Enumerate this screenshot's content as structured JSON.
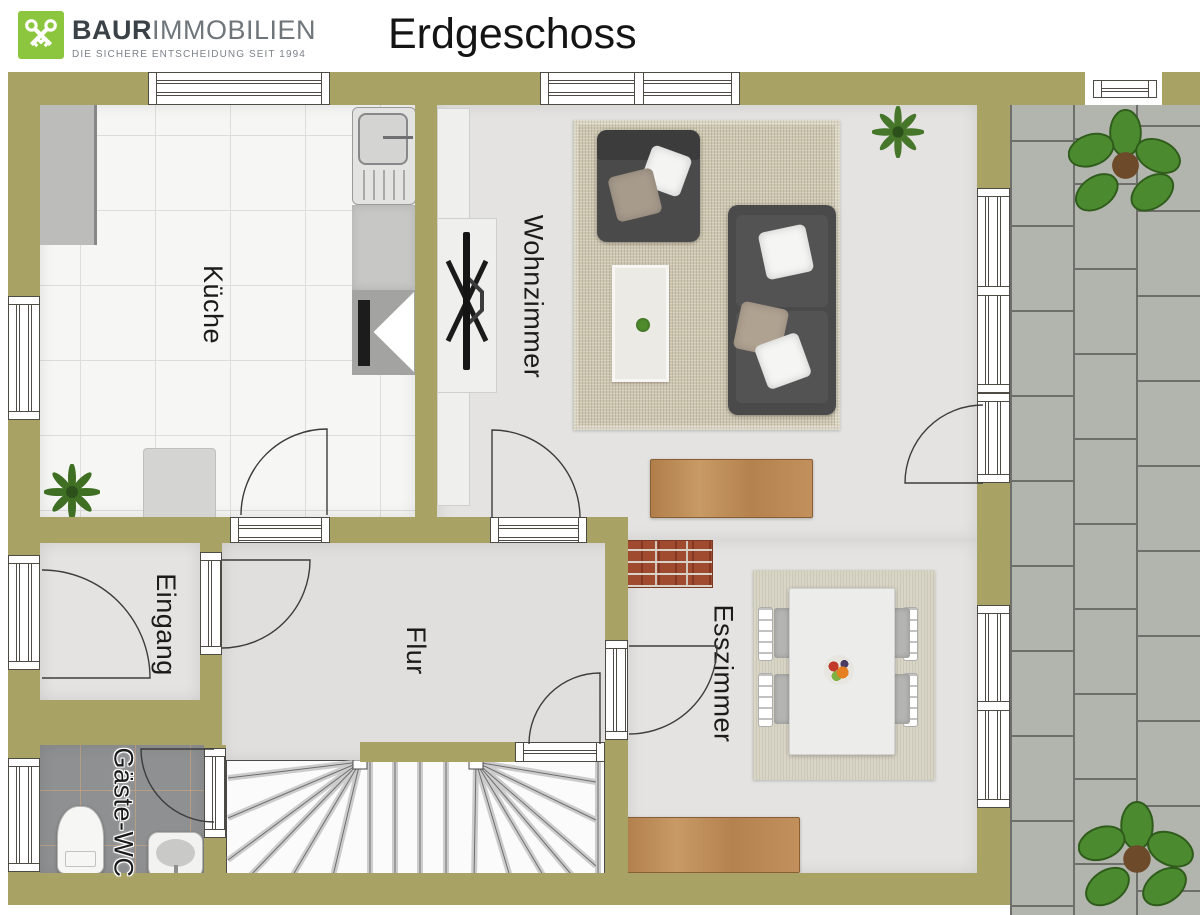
{
  "header": {
    "brand_bold": "BAUR",
    "brand_light": "IMMOBILIEN",
    "tagline": "DIE SICHERE ENTSCHEIDUNG SEIT 1994",
    "title": "Erdgeschoss",
    "logo_icon": "crossed-keys-icon"
  },
  "rooms": {
    "kueche": "Küche",
    "wohnzimmer": "Wohnzimmer",
    "eingang": "Eingang",
    "flur": "Flur",
    "gaeste_wc": "Gäste-WC",
    "esszimmer": "Esszimmer"
  },
  "colors": {
    "wall": "#a8a365",
    "logo_green": "#8cc63e",
    "kitchen_tile": "#f6f6f5",
    "room_floor": "#e4e3e1",
    "wc_tile": "#8f9092",
    "terrace_paver": "#b2b4ae",
    "rug": "#ccc5af",
    "sofa": "#4a4a4a",
    "wood": "#bb8a57",
    "brick": "#a04a30"
  }
}
